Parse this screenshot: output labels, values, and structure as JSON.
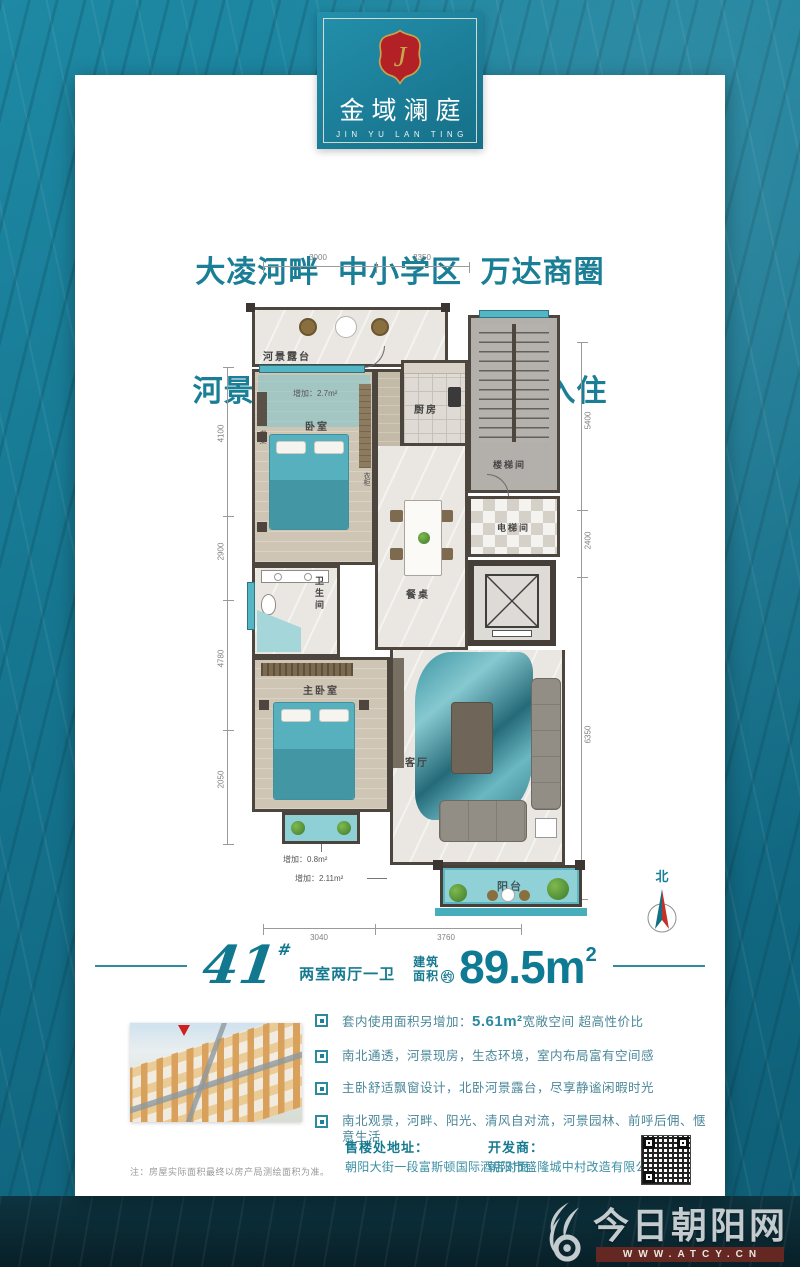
{
  "brand": {
    "name_cn": "金域澜庭",
    "name_en": "JIN YU LAN TING",
    "crest_monogram": "J"
  },
  "headline": {
    "line1": "大凌河畔  中小学区  万达商圈",
    "line2": "河景现房  首付 5 万  即可入住"
  },
  "floorplan": {
    "rooms": {
      "terrace": "河景露台",
      "bedroom": "卧室",
      "kitchen": "厨房",
      "stairwell": "楼梯间",
      "elevator_hall": "电梯间",
      "bathroom": "卫生间",
      "dining_table": "餐桌",
      "master_bedroom": "主卧室",
      "living_room": "客厅",
      "balcony": "阳台",
      "fridge": "冰箱",
      "wine_cabinet": "酒柜",
      "shoe_cabinet": "鞋柜",
      "display_cabinet": "展示柜",
      "desk": "书桌",
      "wardrobe": "衣柜"
    },
    "extras": {
      "terrace_add": "增加：2.7m²",
      "bay_add": "增加：0.8m²",
      "balcony_add": "增加：2.11m²"
    },
    "dims": {
      "top": [
        "3000",
        "2350"
      ],
      "left": [
        "4100",
        "2900",
        "4780",
        "2050"
      ],
      "right": [
        "5400",
        "2400",
        "6350"
      ],
      "bottom": [
        "3040",
        "3760"
      ]
    },
    "north_label": "北"
  },
  "unit": {
    "number": "41",
    "hash": "#",
    "layout": "两室两厅一卫",
    "area_label_line1": "建筑",
    "area_label_line2": "面积",
    "area_approx": "约",
    "area_value": "89.5m",
    "area_sup": "2"
  },
  "features": [
    {
      "pre": "套内使用面积另增加：",
      "value": "5.61m²",
      "post": "宽敞空间 超高性价比"
    },
    {
      "text": "南北通透，河景现房，生态环境，室内布局富有空间感"
    },
    {
      "text": "主卧舒适飘窗设计，北卧河景露台，尽享静谧闲暇时光"
    },
    {
      "text": "南北观景，河畔、阳光、清风自对流，河景园林、前呼后佣、惬意生活"
    }
  ],
  "contact": {
    "sales_label": "售楼处地址：",
    "sales_value": "朝阳大街一段富斯顿国际酒店对面",
    "dev_label": "开发商：",
    "dev_value": "朝阳市盛隆城中村改造有限公司"
  },
  "note": "注：房屋实际面积最终以房产局测绘面积为准。",
  "watermark": {
    "site_name": "今日朝阳网",
    "site_url": "WWW.ATCY.CN"
  },
  "colors": {
    "background_teal": "#177a95",
    "accent_teal": "#15798f",
    "dark_band": "#0a2c37",
    "crest_red": "#b32025",
    "gold": "#c9a44c",
    "url_band_red": "#642722"
  }
}
